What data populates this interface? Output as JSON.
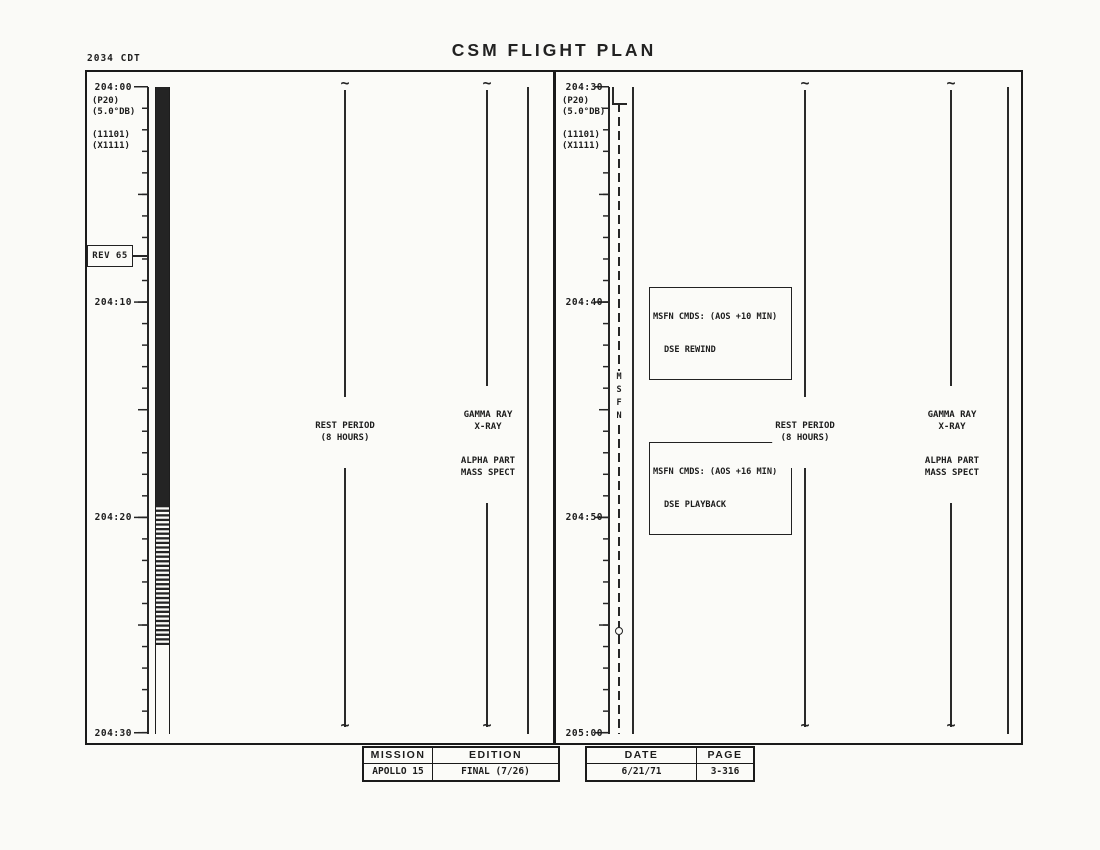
{
  "doc": {
    "clock": "2034 CDT",
    "title": "CSM FLIGHT PLAN"
  },
  "left": {
    "time_labels": [
      "204:00",
      "204:10",
      "204:20",
      "204:30"
    ],
    "annotations": [
      "(P20)",
      "(5.0°DB)",
      "(11101)",
      "(X1111)"
    ],
    "rev": "REV 65",
    "rest": [
      "REST PERIOD",
      "(8 HOURS)"
    ],
    "experiments": [
      "GAMMA RAY",
      "X-RAY",
      "ALPHA PART",
      "MASS SPECT"
    ]
  },
  "right": {
    "time_labels": [
      "204:30",
      "204:40",
      "204:50",
      "205:00"
    ],
    "annotations": [
      "(P20)",
      "(5.0°DB)",
      "(11101)",
      "(X1111)"
    ],
    "msfn": [
      "M",
      "S",
      "F",
      "N"
    ],
    "callouts": [
      {
        "line1": "MSFN CMDS: (AOS +10 MIN)",
        "line2": "DSE REWIND"
      },
      {
        "line1": "MSFN CMDS: (AOS +16 MIN)",
        "line2": "DSE PLAYBACK"
      }
    ],
    "rest": [
      "REST PERIOD",
      "(8 HOURS)"
    ],
    "experiments": [
      "GAMMA RAY",
      "X-RAY",
      "ALPHA PART",
      "MASS SPECT"
    ]
  },
  "footer": {
    "headers": {
      "mission": "MISSION",
      "edition": "EDITION",
      "date": "DATE",
      "page": "PAGE"
    },
    "values": {
      "mission": "APOLLO 15",
      "edition": "FINAL (7/26)",
      "date": "6/21/71",
      "page": "3-316"
    }
  }
}
